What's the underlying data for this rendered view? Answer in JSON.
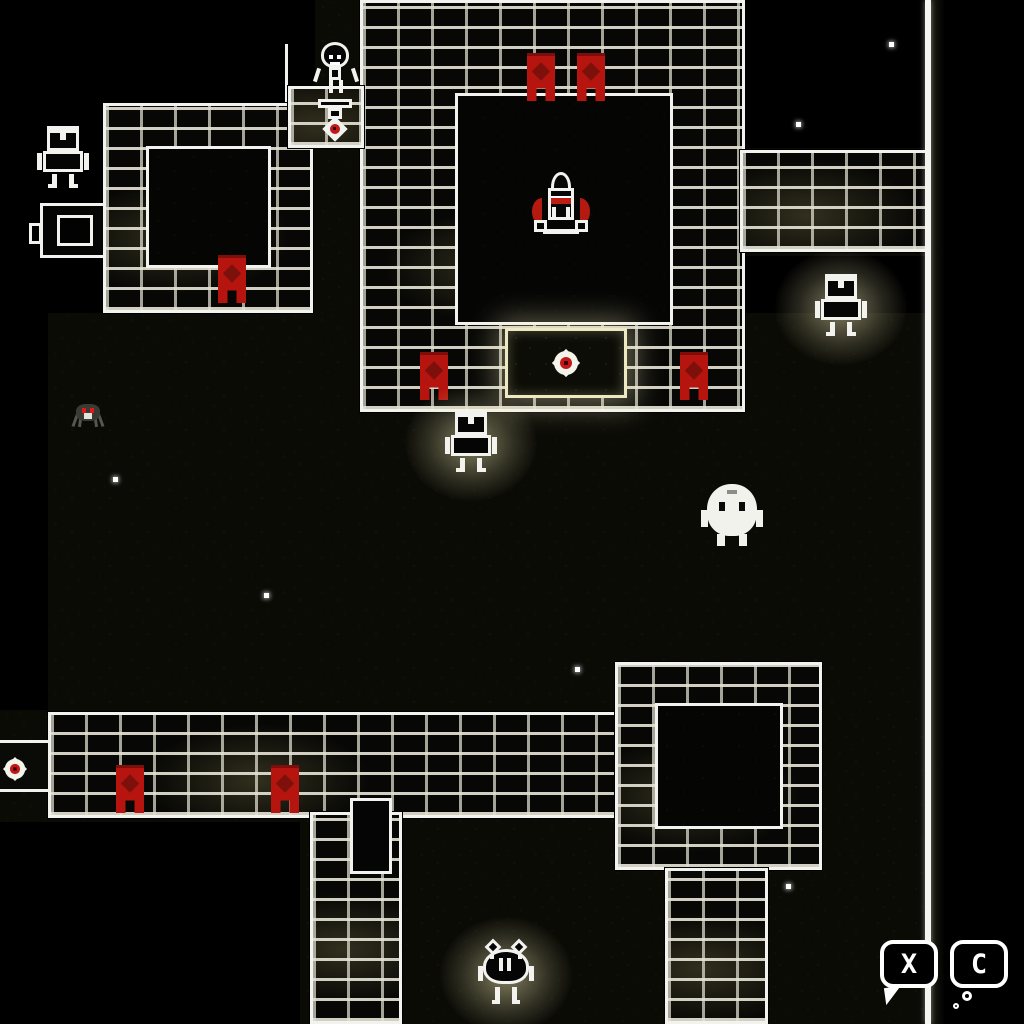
{
  "scene": {
    "title": "space-roguelike-dungeon-map",
    "width": 1024,
    "height": 1024,
    "bg": "#000000"
  },
  "palette": {
    "wall_outline": "#f2f2ee",
    "wall_brick": "#070705",
    "mortar": "#e2e0d2",
    "mortar_warm": "#afa464",
    "floor_base": "#0b0b06",
    "floor_speck": "#232314",
    "banner_red": "#b5150e",
    "banner_emblem_red": "#7d100b",
    "seal_red": "#c41818",
    "glow_yellow": "#faf2b9",
    "sprite_white": "#f2f2ed",
    "spider_grey": "#3a3a34",
    "spider_eye_red": "#e01818"
  },
  "map": {
    "edge_line": {
      "x": 925,
      "y": 0,
      "w": 6,
      "h": 1024
    },
    "edge_shade": {
      "x": 931,
      "y": 0,
      "w": 14,
      "h": 1024
    },
    "statue_edge_line": {
      "x": 285,
      "y": 44,
      "w": 3,
      "h": 104
    },
    "floor_patches": [
      {
        "x": 315,
        "y": 0,
        "w": 430,
        "h": 415
      },
      {
        "x": 103,
        "y": 103,
        "w": 212,
        "h": 212
      },
      {
        "x": 737,
        "y": 148,
        "w": 190,
        "h": 108
      },
      {
        "x": 48,
        "y": 313,
        "w": 878,
        "h": 402
      },
      {
        "x": 300,
        "y": 712,
        "w": 628,
        "h": 312
      },
      {
        "x": 0,
        "y": 710,
        "w": 300,
        "h": 112
      }
    ],
    "walls": [
      {
        "name": "rocket-room-wall",
        "x": 360,
        "y": 0,
        "w": 385,
        "h": 412
      },
      {
        "name": "top-left-room-wall",
        "x": 103,
        "y": 103,
        "w": 210,
        "h": 210
      },
      {
        "name": "top-right-corridor-wall",
        "x": 740,
        "y": 150,
        "w": 188,
        "h": 102
      },
      {
        "name": "bottom-corridor-wall",
        "x": 48,
        "y": 712,
        "w": 596,
        "h": 106
      },
      {
        "name": "bottom-right-room-wall",
        "x": 615,
        "y": 662,
        "w": 207,
        "h": 208
      },
      {
        "name": "left-vertical-wall",
        "x": 310,
        "y": 812,
        "w": 92,
        "h": 212
      },
      {
        "name": "right-vertical-wall",
        "x": 665,
        "y": 868,
        "w": 103,
        "h": 156
      },
      {
        "name": "statue-platform-wall",
        "x": 288,
        "y": 86,
        "w": 76,
        "h": 62
      }
    ],
    "room_floors": [
      {
        "name": "rocket-room-floor",
        "x": 455,
        "y": 93,
        "w": 218,
        "h": 232
      },
      {
        "name": "top-left-room-floor",
        "x": 146,
        "y": 146,
        "w": 125,
        "h": 122
      },
      {
        "name": "bottom-right-room-floor",
        "x": 655,
        "y": 703,
        "w": 128,
        "h": 126
      }
    ],
    "gate": {
      "x": 505,
      "y": 328,
      "w": 122,
      "h": 70
    },
    "passage_slot": {
      "x": 350,
      "y": 798,
      "w": 42,
      "h": 76
    },
    "left_door": {
      "x": 40,
      "y": 203,
      "w": 66,
      "h": 55
    },
    "left_corridor_door": {
      "x": 0,
      "y": 740,
      "w": 48,
      "h": 52
    },
    "banners": [
      {
        "x": 527,
        "y": 53
      },
      {
        "x": 577,
        "y": 53
      },
      {
        "x": 420,
        "y": 352
      },
      {
        "x": 680,
        "y": 352
      },
      {
        "x": 218,
        "y": 255
      },
      {
        "x": 116,
        "y": 765
      },
      {
        "x": 271,
        "y": 765
      }
    ],
    "stars": [
      {
        "x": 889,
        "y": 42
      },
      {
        "x": 796,
        "y": 122
      },
      {
        "x": 463,
        "y": 281
      },
      {
        "x": 264,
        "y": 593
      },
      {
        "x": 575,
        "y": 667
      },
      {
        "x": 786,
        "y": 884
      },
      {
        "x": 366,
        "y": 872
      },
      {
        "x": 113,
        "y": 477
      }
    ]
  },
  "entities": {
    "rocket": {
      "label": "rocket-ship",
      "pos": {
        "x": 533,
        "y": 172,
        "w": 56,
        "h": 64
      }
    },
    "statue": {
      "label": "shrine-statue-with-red-orb",
      "pos": {
        "x": 312,
        "y": 42,
        "w": 48,
        "h": 104
      }
    },
    "robot_left": {
      "label": "robot-creature",
      "pos": {
        "x": 40,
        "y": 126,
        "w": 46,
        "h": 64
      }
    },
    "robot_center": {
      "label": "glowing-robot-creature",
      "pos": {
        "x": 448,
        "y": 410,
        "w": 46,
        "h": 64
      }
    },
    "robot_right": {
      "label": "glowing-robot-creature",
      "pos": {
        "x": 818,
        "y": 274,
        "w": 46,
        "h": 64
      }
    },
    "blob": {
      "label": "white-blob-creature",
      "pos": {
        "x": 703,
        "y": 480,
        "w": 58,
        "h": 66
      }
    },
    "spider_small": {
      "label": "small-spider-creature",
      "pos": {
        "x": 70,
        "y": 396,
        "w": 36,
        "h": 36
      }
    },
    "spider_bottom": {
      "label": "glowing-spider-creature",
      "pos": {
        "x": 478,
        "y": 940,
        "w": 56,
        "h": 68
      }
    }
  },
  "controls": {
    "x_button": {
      "label": "X",
      "pos": {
        "x": 880,
        "y": 940,
        "w": 66,
        "h": 80
      }
    },
    "c_button": {
      "label": "C",
      "pos": {
        "x": 950,
        "y": 940,
        "w": 66,
        "h": 80
      }
    }
  }
}
